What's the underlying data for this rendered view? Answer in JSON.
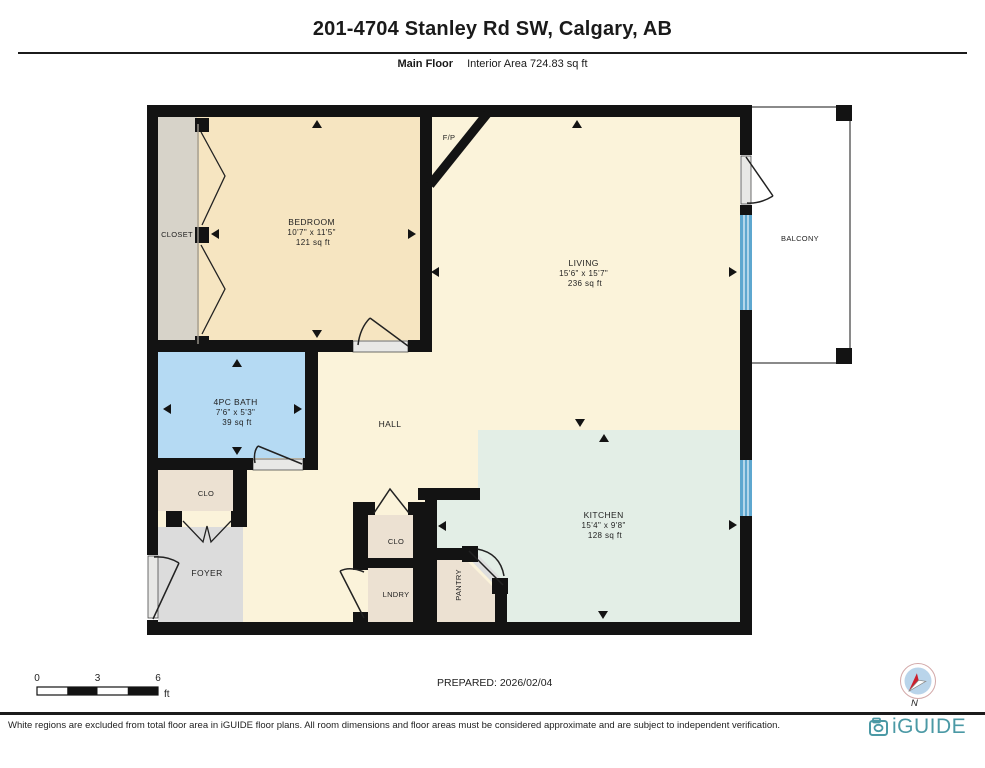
{
  "header": {
    "title": "201-4704 Stanley Rd SW, Calgary, AB",
    "floor_label": "Main Floor",
    "area_label": "Interior Area 724.83 sq ft"
  },
  "rooms": {
    "bedroom": {
      "name": "BEDROOM",
      "dims": "10'7\" x 11'5\"",
      "area": "121 sq ft"
    },
    "living": {
      "name": "LIVING",
      "dims": "15'6\" x 15'7\"",
      "area": "236 sq ft"
    },
    "bath": {
      "name": "4PC BATH",
      "dims": "7'6\" x 5'3\"",
      "area": "39 sq ft"
    },
    "kitchen": {
      "name": "KITCHEN",
      "dims": "15'4\" x 9'8\"",
      "area": "128 sq ft"
    },
    "closet": {
      "name": "CLOSET"
    },
    "hall": {
      "name": "HALL"
    },
    "balcony": {
      "name": "BALCONY"
    },
    "foyer": {
      "name": "FOYER"
    },
    "clo_bath": {
      "name": "CLO"
    },
    "clo_hall": {
      "name": "CLO"
    },
    "laundry": {
      "name": "LNDRY"
    },
    "pantry": {
      "name": "PANTRY"
    },
    "fireplace": {
      "name": "F/P"
    }
  },
  "scale_bar": {
    "tick_0": "0",
    "tick_3": "3",
    "tick_6": "6",
    "unit": "ft"
  },
  "prepared_label": "PREPARED: 2026/02/04",
  "compass": {
    "north_label": "N"
  },
  "footer": {
    "disclaimer": "White regions are excluded from total floor area in iGUIDE floor plans. All room dimensions and floor areas must be considered approximate and are subject to independent verification.",
    "brand": "iGUIDE"
  },
  "colors": {
    "wall": "#131313",
    "living_hall": "#fbf3da",
    "bedroom": "#f6e5c1",
    "bath": "#b5daf3",
    "kitchen": "#e3eee6",
    "closet": "#d7d3c9",
    "storage": "#ece1d2",
    "foyer": "#dcdcdc",
    "window": "#5ea7cf",
    "window_stripe": "#d8ebf6",
    "door_sill": "#e8e8e6",
    "brand": "#4b99a5",
    "compass_disc": "#b9d4ea",
    "compass_needle": "#cc1f2d"
  }
}
